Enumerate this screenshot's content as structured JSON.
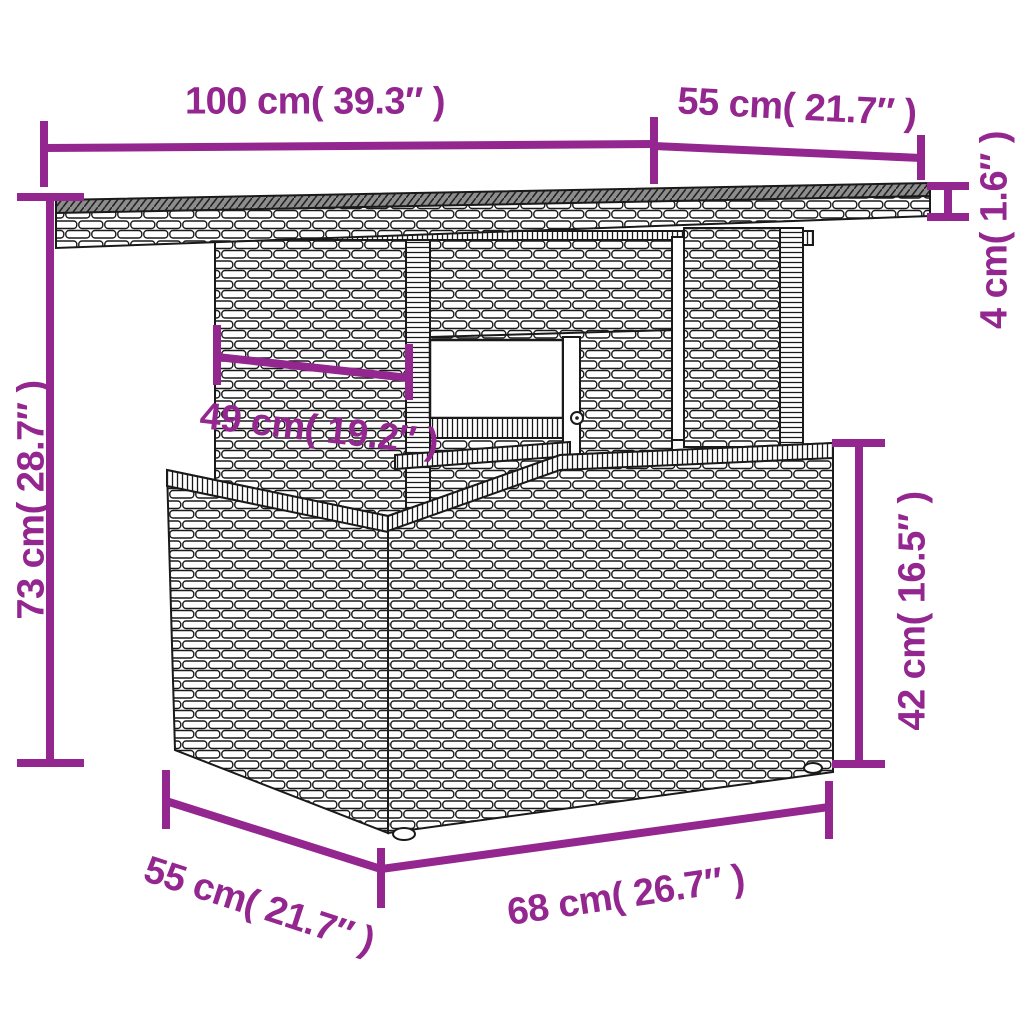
{
  "page": {
    "background": "#ffffff",
    "description": "Dimension diagram of a poly rattan garden table with storage base"
  },
  "colors": {
    "dimension": "#93278F",
    "outline": "#1a1a1a",
    "tabletop_surface": "#8d8d8d"
  },
  "diagram": {
    "subject": "wicker-garden-table",
    "dimensions": {
      "tabletop_width": {
        "label": "100 cm( 39.3″ )"
      },
      "tabletop_depth": {
        "label": "55 cm( 21.7″ )"
      },
      "tabletop_thickness": {
        "label": "4 cm( 1.6″ )"
      },
      "total_height": {
        "label": "73 cm( 28.7″ )"
      },
      "leg_inset_width": {
        "label": "49 cm( 19.2″ )"
      },
      "base_height": {
        "label": "42 cm( 16.5″ )"
      },
      "base_depth": {
        "label": "55 cm( 21.7″ )"
      },
      "base_width": {
        "label": "68 cm( 26.7″ )"
      }
    }
  }
}
